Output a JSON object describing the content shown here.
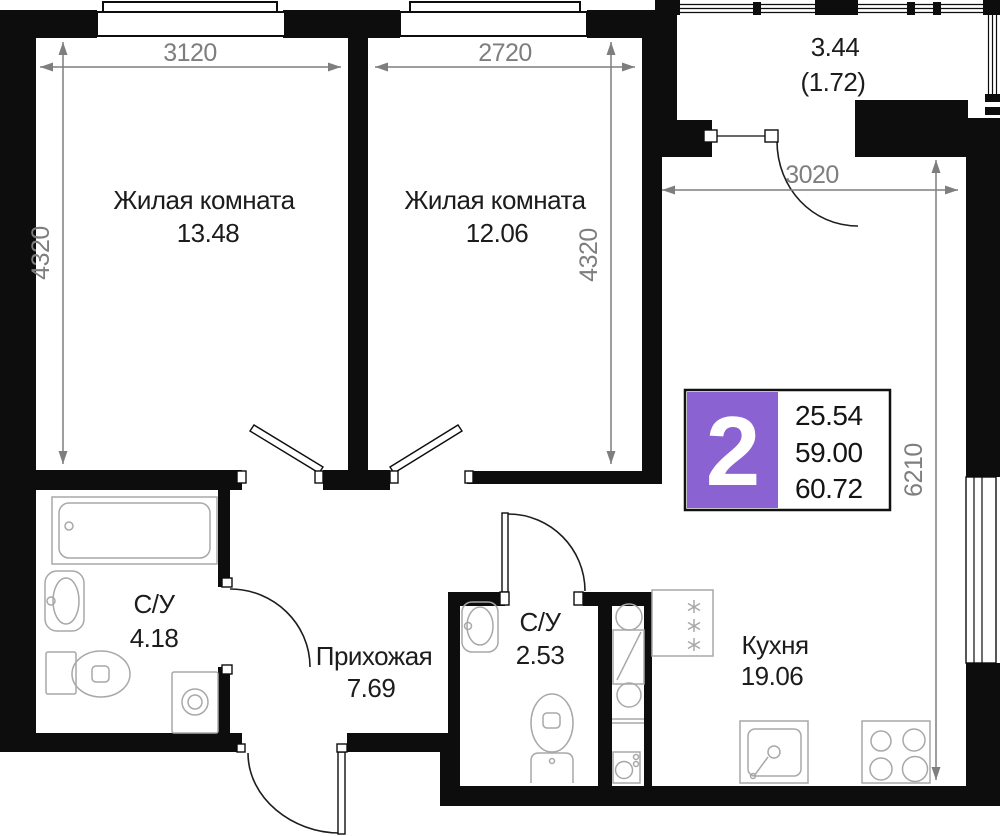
{
  "rooms": {
    "room1": {
      "name": "Жилая комната",
      "area": "13.48"
    },
    "room2": {
      "name": "Жилая комната",
      "area": "12.06"
    },
    "bathroom1": {
      "name": "С/У",
      "area": "4.18"
    },
    "hallway": {
      "name": "Прихожая",
      "area": "7.69"
    },
    "bathroom2": {
      "name": "С/У",
      "area": "2.53"
    },
    "kitchen": {
      "name": "Кухня",
      "area": "19.06"
    },
    "balcony": {
      "area": "3.44",
      "area_coef": "(1.72)"
    }
  },
  "dimensions": {
    "room1_width": "3120",
    "room1_depth": "4320",
    "room2_width": "2720",
    "room2_depth": "4320",
    "kitchen_width": "3020",
    "kitchen_depth": "6210"
  },
  "badge": {
    "rooms_count": "2",
    "living_area": "25.54",
    "area_without_balcony": "59.00",
    "total_area": "60.72",
    "accent_color": "#8b62d1"
  }
}
